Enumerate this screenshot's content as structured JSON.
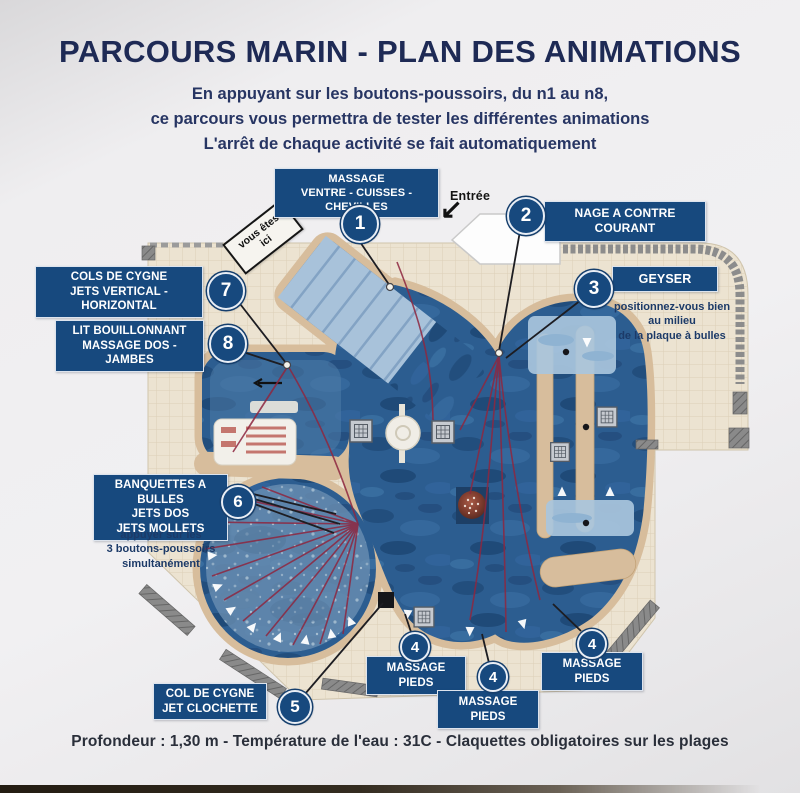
{
  "title": "PARCOURS MARIN - PLAN DES ANIMATIONS",
  "subtitle": [
    "En appuyant sur les boutons-poussoirs, du n1 au n8,",
    "ce parcours vous permettra de tester les différentes animations",
    "L'arrêt de chaque activité se fait automatiquement"
  ],
  "entrance": {
    "label": "Entrée",
    "arrow_icon": "↙"
  },
  "you_are_here": {
    "line1": "vous êtes",
    "line2": "ici"
  },
  "stations": {
    "1": {
      "number": "1",
      "lines": [
        "MASSAGE",
        "VENTRE - CUISSES - CHEVILLES"
      ]
    },
    "2": {
      "number": "2",
      "lines": [
        "NAGE A CONTRE COURANT"
      ]
    },
    "3": {
      "number": "3",
      "lines": [
        "GEYSER"
      ],
      "note": [
        "positionnez-vous bien",
        "au milieu",
        "de la plaque à bulles"
      ]
    },
    "4": {
      "number": "4",
      "lines": [
        "MASSAGE PIEDS"
      ]
    },
    "5": {
      "number": "5",
      "lines": [
        "COL DE CYGNE",
        "JET CLOCHETTE"
      ]
    },
    "6": {
      "number": "6",
      "lines": [
        "BANQUETTES A BULLES",
        "JETS DOS",
        "JETS MOLLETS"
      ],
      "note": [
        "appuyer sur les",
        "3 boutons-poussoirs",
        "simultanément"
      ]
    },
    "7": {
      "number": "7",
      "lines": [
        "COLS DE CYGNE",
        "JETS VERTICAL - HORIZONTAL"
      ]
    },
    "8": {
      "number": "8",
      "lines": [
        "LIT BOUILLONNANT",
        "MASSAGE DOS - JAMBES"
      ]
    }
  },
  "footer": "Profondeur : 1,30 m - Température de l'eau : 31C - Claquettes obligatoires sur les plages",
  "colors": {
    "badge_blue": "#17497e",
    "title_navy": "#1e2a55",
    "deck_beige": "#ece3d1",
    "sand": "#d7bd9c",
    "water_dark": "#2c5d90",
    "water_light": "#a8c2da",
    "red_lines": "#8e2740"
  }
}
